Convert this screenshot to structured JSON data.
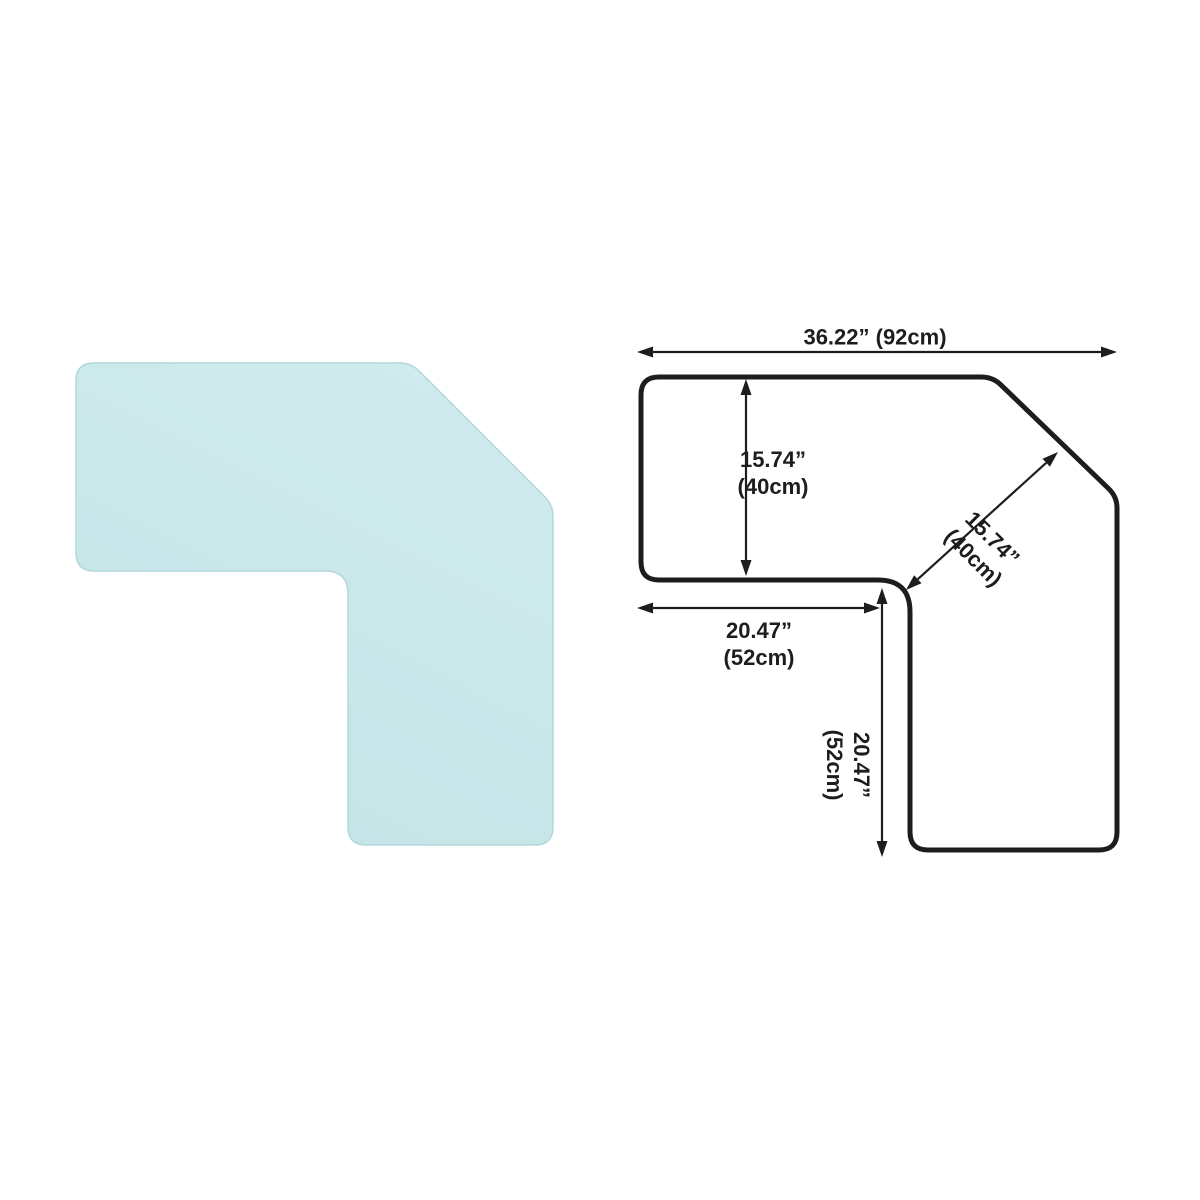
{
  "page": {
    "background": "#ffffff",
    "description": "L-shaped corner chair mat product photo with dimension diagram"
  },
  "mat": {
    "name": "l-shaped-corner-mat",
    "fill_top": "#d0ebed",
    "fill_bottom": "#c3e4e7",
    "edge_color": "#b2d8db"
  },
  "diagram": {
    "stroke_color": "#1d1d1f",
    "text_color": "#1d1d1f",
    "dimensions": {
      "total_width": {
        "label": "36.22” (92cm)",
        "inches": 36.22,
        "cm": 92
      },
      "left_arm_height": {
        "line1": "15.74”",
        "line2": "(40cm)",
        "inches": 15.74,
        "cm": 40
      },
      "diagonal_depth": {
        "line1": "15.74”",
        "line2": "(40cm)",
        "inches": 15.74,
        "cm": 40
      },
      "left_arm_length": {
        "line1": "20.47”",
        "line2": "(52cm)",
        "inches": 20.47,
        "cm": 52
      },
      "right_arm_length": {
        "line1": "20.47”",
        "line2": "(52cm)",
        "inches": 20.47,
        "cm": 52
      }
    }
  }
}
